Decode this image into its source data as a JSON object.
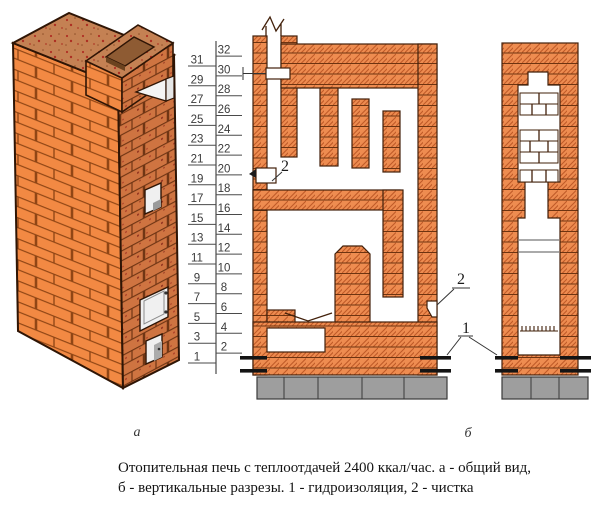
{
  "figure": {
    "caption_line1": "Отопительная печь с теплоотдачей 2400 ккал/час. а - общий вид,",
    "caption_line2": "б - вертикальные разрезы. 1 - гидроизоляция, 2 - чистка",
    "label_view_a": "а",
    "label_view_b": "б",
    "callout_cleanout_top": "2",
    "callout_cleanout_right": "2",
    "callout_waterproofing": "1"
  },
  "scale": {
    "numbers": [
      1,
      2,
      3,
      4,
      5,
      6,
      7,
      8,
      9,
      10,
      11,
      12,
      13,
      14,
      15,
      16,
      17,
      18,
      19,
      20,
      21,
      22,
      23,
      24,
      25,
      26,
      27,
      28,
      29,
      30,
      31,
      32
    ]
  },
  "colors": {
    "brick_fill": "#EE8C50",
    "hatch_line": "#C05A28",
    "course_line": "#7A3A15",
    "outline": "#42200A",
    "brick_face_left": "#F28943",
    "brick_face_right": "#CF7441",
    "top_face": "#C48153",
    "speckle": "#B03024",
    "foundation_gray": "#9E9E9E",
    "background": "#FFFFFF"
  }
}
